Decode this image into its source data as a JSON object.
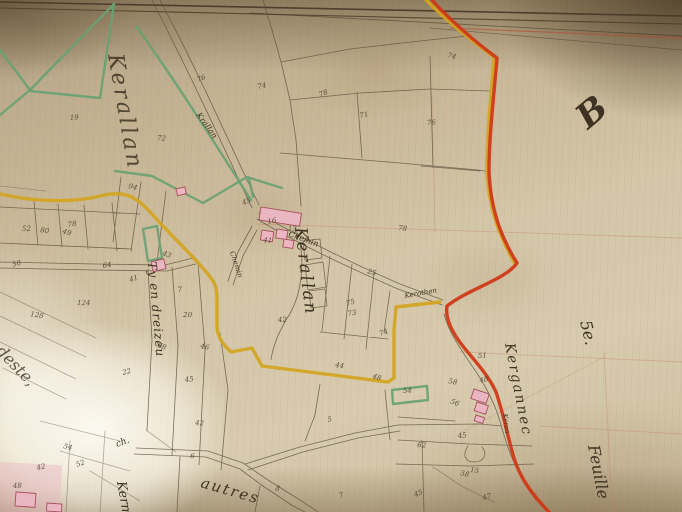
{
  "colors": {
    "paper-mid": "#d2c3a5",
    "boundary-red": "#cf3a17",
    "road-yellow": "#d2a41e",
    "boundary-green": "#69a173",
    "building-pink": "#e9b6c2",
    "building-outline": "#a4505c",
    "ink-sepia": "#5f5340",
    "ink-dark": "#3e3323",
    "grid-pink": "#c4806a",
    "border-dark": "#473827"
  },
  "labels": {
    "kerallan_large": "Kerallan",
    "kerallan_hamlet": "Kerallan",
    "krallan_road": "Krallan",
    "chemin_road": "Chemin",
    "chemin_branch": "Chemin",
    "tyendreizeu": "Ty en dreizeu",
    "kergannec": "Kergannec",
    "keran_small": "Keran",
    "kerothen_road": "Kerothen",
    "section_letter": "B",
    "sheet_number": "5e.",
    "sheet_word": "Feuille",
    "modeste": "modeste,",
    "kern_partial": "Kerm",
    "autres": "autres",
    "ch_abbrev": "ch."
  },
  "parcels": [
    {
      "x": 198,
      "y": 82,
      "n": "76"
    },
    {
      "x": 258,
      "y": 89,
      "n": "74"
    },
    {
      "x": 70,
      "y": 120,
      "n": "19"
    },
    {
      "x": 157,
      "y": 140,
      "n": "72"
    },
    {
      "x": 128,
      "y": 188,
      "n": "94"
    },
    {
      "x": 320,
      "y": 97,
      "n": "78"
    },
    {
      "x": 360,
      "y": 118,
      "n": "71"
    },
    {
      "x": 427,
      "y": 125,
      "n": "76"
    },
    {
      "x": 398,
      "y": 230,
      "n": "78"
    },
    {
      "x": 447,
      "y": 57,
      "n": "74"
    },
    {
      "x": 243,
      "y": 205,
      "n": "45"
    },
    {
      "x": 268,
      "y": 224,
      "n": "16"
    },
    {
      "x": 288,
      "y": 231,
      "n": "13"
    },
    {
      "x": 263,
      "y": 242,
      "n": "41"
    },
    {
      "x": 367,
      "y": 273,
      "n": "25"
    },
    {
      "x": 347,
      "y": 306,
      "n": "75"
    },
    {
      "x": 348,
      "y": 316,
      "n": "73"
    },
    {
      "x": 278,
      "y": 322,
      "n": "42"
    },
    {
      "x": 335,
      "y": 367,
      "n": "44"
    },
    {
      "x": 372,
      "y": 378,
      "n": "48"
    },
    {
      "x": 380,
      "y": 336,
      "n": "74"
    },
    {
      "x": 68,
      "y": 227,
      "n": "78"
    },
    {
      "x": 22,
      "y": 231,
      "n": "52"
    },
    {
      "x": 40,
      "y": 232,
      "n": "80"
    },
    {
      "x": 62,
      "y": 233,
      "n": "49"
    },
    {
      "x": 13,
      "y": 267,
      "n": "50"
    },
    {
      "x": 103,
      "y": 268,
      "n": "64"
    },
    {
      "x": 77,
      "y": 305,
      "n": "124"
    },
    {
      "x": 30,
      "y": 316,
      "n": "128"
    },
    {
      "x": 162,
      "y": 255,
      "n": "43"
    },
    {
      "x": 130,
      "y": 282,
      "n": "41"
    },
    {
      "x": 178,
      "y": 292,
      "n": "7"
    },
    {
      "x": 183,
      "y": 317,
      "n": "20"
    },
    {
      "x": 200,
      "y": 348,
      "n": "46"
    },
    {
      "x": 157,
      "y": 347,
      "n": "68"
    },
    {
      "x": 123,
      "y": 375,
      "n": "22"
    },
    {
      "x": 185,
      "y": 382,
      "n": "45"
    },
    {
      "x": 195,
      "y": 425,
      "n": "42"
    },
    {
      "x": 448,
      "y": 383,
      "n": "58"
    },
    {
      "x": 450,
      "y": 403,
      "n": "56"
    },
    {
      "x": 480,
      "y": 383,
      "n": "48"
    },
    {
      "x": 458,
      "y": 438,
      "n": "45"
    },
    {
      "x": 417,
      "y": 447,
      "n": "62"
    },
    {
      "x": 460,
      "y": 475,
      "n": "58"
    },
    {
      "x": 415,
      "y": 497,
      "n": "45"
    },
    {
      "x": 483,
      "y": 500,
      "n": "47"
    },
    {
      "x": 403,
      "y": 393,
      "n": "54"
    },
    {
      "x": 190,
      "y": 458,
      "n": "6"
    },
    {
      "x": 275,
      "y": 490,
      "n": "8"
    },
    {
      "x": 340,
      "y": 498,
      "n": "7"
    },
    {
      "x": 328,
      "y": 422,
      "n": "5"
    },
    {
      "x": 478,
      "y": 358,
      "n": "51"
    },
    {
      "x": 470,
      "y": 472,
      "n": "15"
    },
    {
      "x": 63,
      "y": 448,
      "n": "54"
    },
    {
      "x": 77,
      "y": 467,
      "n": "52"
    },
    {
      "x": 37,
      "y": 470,
      "n": "42"
    },
    {
      "x": 13,
      "y": 488,
      "n": "48"
    }
  ]
}
